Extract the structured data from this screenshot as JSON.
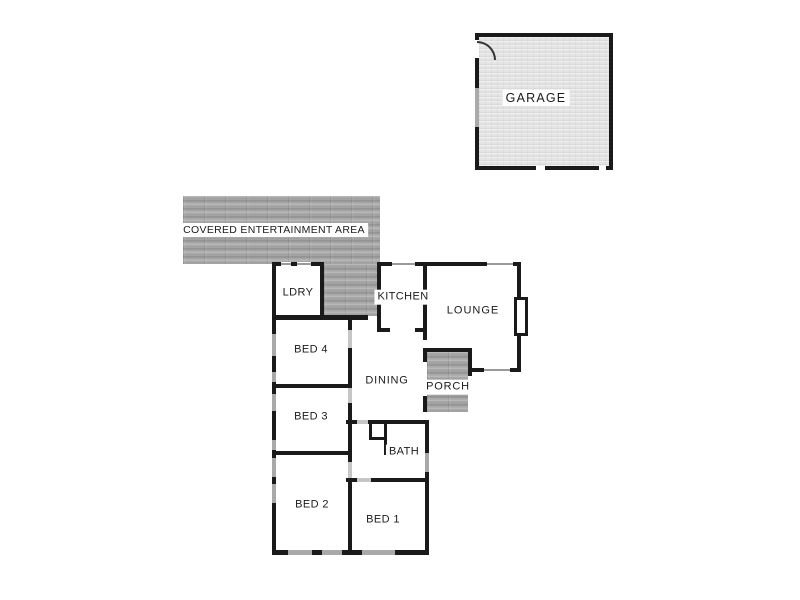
{
  "document_type": "residential floor plan",
  "colors": {
    "background": "#ffffff",
    "wall": "#1a1a1a",
    "window_block": "#a9a9a9",
    "door_block": "#c6c6c6",
    "deck_texture_base": "#9e9e9e",
    "garage_floor": "#e4e4e4",
    "label_bg": "#ffffff",
    "label_text": "#1b1b1b"
  },
  "rooms": {
    "garage": {
      "label": "GARAGE"
    },
    "covered_entertainment_area": {
      "label": "COVERED ENTERTAINMENT AREA"
    },
    "ldry": {
      "label": "LDRY"
    },
    "kitchen": {
      "label": "KITCHEN"
    },
    "lounge": {
      "label": "LOUNGE"
    },
    "dining": {
      "label": "DINING"
    },
    "porch": {
      "label": "PORCH"
    },
    "bed4": {
      "label": "BED 4"
    },
    "bed3": {
      "label": "BED 3"
    },
    "bath": {
      "label": "BATH"
    },
    "bed2": {
      "label": "BED 2"
    },
    "bed1": {
      "label": "BED 1"
    }
  },
  "plan": {
    "canvas": {
      "width": 800,
      "height": 600
    },
    "shapes": [
      {
        "name": "deck-entertainment-main",
        "cls": "deck",
        "x": 183,
        "y": 196,
        "w": 197,
        "h": 68
      },
      {
        "name": "deck-entertainment-ext",
        "cls": "deck",
        "x": 324,
        "y": 264,
        "w": 53,
        "h": 52
      },
      {
        "name": "deck-porch",
        "cls": "deck",
        "x": 427,
        "y": 352,
        "w": 41,
        "h": 60
      },
      {
        "name": "garage-floor",
        "cls": "garage",
        "x": 475,
        "y": 33,
        "w": 138,
        "h": 137
      },
      {
        "name": "wall",
        "cls": "wall",
        "x": 272,
        "y": 262,
        "w": 52,
        "h": 4
      },
      {
        "name": "wall",
        "cls": "wall",
        "x": 377,
        "y": 262,
        "w": 144,
        "h": 4
      },
      {
        "name": "wall",
        "cls": "wall",
        "x": 272,
        "y": 262,
        "w": 4,
        "h": 293
      },
      {
        "name": "wall",
        "cls": "wall",
        "x": 272,
        "y": 550,
        "w": 157,
        "h": 5
      },
      {
        "name": "wall",
        "cls": "wall",
        "x": 425,
        "y": 420,
        "w": 4,
        "h": 135
      },
      {
        "name": "wall",
        "cls": "wall",
        "x": 320,
        "y": 262,
        "w": 4,
        "h": 57
      },
      {
        "name": "wall",
        "cls": "wall",
        "x": 272,
        "y": 315,
        "w": 96,
        "h": 5
      },
      {
        "name": "wall",
        "cls": "wall",
        "x": 348,
        "y": 315,
        "w": 4,
        "h": 15
      },
      {
        "name": "wall",
        "cls": "wall",
        "x": 348,
        "y": 348,
        "w": 4,
        "h": 40
      },
      {
        "name": "wall",
        "cls": "wall",
        "x": 348,
        "y": 403,
        "w": 4,
        "h": 59
      },
      {
        "name": "wall",
        "cls": "wall",
        "x": 348,
        "y": 478,
        "w": 4,
        "h": 77
      },
      {
        "name": "wall",
        "cls": "wall",
        "x": 272,
        "y": 384,
        "w": 80,
        "h": 4
      },
      {
        "name": "wall",
        "cls": "wall",
        "x": 272,
        "y": 451,
        "w": 80,
        "h": 4
      },
      {
        "name": "wall",
        "cls": "wall",
        "x": 377,
        "y": 262,
        "w": 4,
        "h": 70
      },
      {
        "name": "wall",
        "cls": "wall",
        "x": 377,
        "y": 328,
        "w": 13,
        "h": 4
      },
      {
        "name": "wall",
        "cls": "wall",
        "x": 415,
        "y": 328,
        "w": 12,
        "h": 4
      },
      {
        "name": "wall",
        "cls": "wall",
        "x": 423,
        "y": 262,
        "w": 4,
        "h": 78
      },
      {
        "name": "wall",
        "cls": "wall",
        "x": 346,
        "y": 420,
        "w": 83,
        "h": 4
      },
      {
        "name": "wall",
        "cls": "wall",
        "x": 346,
        "y": 478,
        "w": 83,
        "h": 4
      },
      {
        "name": "wall",
        "cls": "wall",
        "x": 369,
        "y": 424,
        "w": 3,
        "h": 16
      },
      {
        "name": "wall",
        "cls": "wall",
        "x": 369,
        "y": 437,
        "w": 18,
        "h": 3
      },
      {
        "name": "wall",
        "cls": "wall",
        "x": 384,
        "y": 424,
        "w": 3,
        "h": 31
      },
      {
        "name": "wall",
        "cls": "wall",
        "x": 423,
        "y": 348,
        "w": 49,
        "h": 4
      },
      {
        "name": "wall",
        "cls": "wall",
        "x": 423,
        "y": 348,
        "w": 4,
        "h": 64
      },
      {
        "name": "wall",
        "cls": "wall",
        "x": 468,
        "y": 348,
        "w": 4,
        "h": 28
      },
      {
        "name": "wall",
        "cls": "wall",
        "x": 468,
        "y": 368,
        "w": 53,
        "h": 4
      },
      {
        "name": "wall",
        "cls": "wall",
        "x": 517,
        "y": 262,
        "w": 4,
        "h": 110
      },
      {
        "name": "front-door-gap",
        "cls": "gap",
        "x": 423,
        "y": 362,
        "w": 4,
        "h": 34
      },
      {
        "name": "door",
        "cls": "door",
        "x": 348,
        "y": 330,
        "w": 4,
        "h": 18
      },
      {
        "name": "door",
        "cls": "door",
        "x": 348,
        "y": 388,
        "w": 4,
        "h": 15
      },
      {
        "name": "door",
        "cls": "door",
        "x": 348,
        "y": 462,
        "w": 4,
        "h": 16
      },
      {
        "name": "door",
        "cls": "door",
        "x": 357,
        "y": 420,
        "w": 11,
        "h": 4
      },
      {
        "name": "door",
        "cls": "door",
        "x": 357,
        "y": 478,
        "w": 14,
        "h": 4
      },
      {
        "name": "window",
        "cls": "win",
        "x": 272,
        "y": 334,
        "w": 4,
        "h": 22
      },
      {
        "name": "window",
        "cls": "win",
        "x": 272,
        "y": 372,
        "w": 4,
        "h": 10
      },
      {
        "name": "window",
        "cls": "win",
        "x": 272,
        "y": 394,
        "w": 4,
        "h": 17
      },
      {
        "name": "window",
        "cls": "win",
        "x": 272,
        "y": 440,
        "w": 4,
        "h": 10
      },
      {
        "name": "window",
        "cls": "win",
        "x": 272,
        "y": 458,
        "w": 4,
        "h": 19
      },
      {
        "name": "window",
        "cls": "win",
        "x": 272,
        "y": 484,
        "w": 4,
        "h": 19
      },
      {
        "name": "window",
        "cls": "win",
        "x": 288,
        "y": 550,
        "w": 24,
        "h": 5
      },
      {
        "name": "window",
        "cls": "win",
        "x": 322,
        "y": 550,
        "w": 20,
        "h": 5
      },
      {
        "name": "window",
        "cls": "win",
        "x": 362,
        "y": 550,
        "w": 33,
        "h": 5
      },
      {
        "name": "window",
        "cls": "win",
        "x": 425,
        "y": 453,
        "w": 4,
        "h": 19
      },
      {
        "name": "window",
        "cls": "winh",
        "x": 281,
        "y": 262,
        "w": 10,
        "h": 4
      },
      {
        "name": "window",
        "cls": "winh",
        "x": 297,
        "y": 262,
        "w": 14,
        "h": 4
      },
      {
        "name": "window",
        "cls": "winh",
        "x": 392,
        "y": 262,
        "w": 23,
        "h": 4
      },
      {
        "name": "window",
        "cls": "winh",
        "x": 487,
        "y": 262,
        "w": 26,
        "h": 4
      },
      {
        "name": "window",
        "cls": "winh",
        "x": 484,
        "y": 368,
        "w": 26,
        "h": 4
      },
      {
        "name": "garage-door-gap",
        "cls": "gap",
        "x": 475,
        "y": 40,
        "w": 4,
        "h": 18
      },
      {
        "name": "garage-window",
        "cls": "win",
        "x": 475,
        "y": 88,
        "w": 4,
        "h": 39
      },
      {
        "name": "garage-panel-joint",
        "cls": "gap",
        "x": 536,
        "y": 166,
        "w": 9,
        "h": 4
      },
      {
        "name": "garage-panel-joint",
        "cls": "gap",
        "x": 599,
        "y": 166,
        "w": 7,
        "h": 4
      },
      {
        "name": "garage-door-arc",
        "cls": "arc",
        "x": 477,
        "y": 41,
        "w": 17,
        "h": 17
      },
      {
        "name": "bay-window",
        "cls": "bay",
        "x": 514,
        "y": 297,
        "w": 14,
        "h": 39
      }
    ]
  }
}
